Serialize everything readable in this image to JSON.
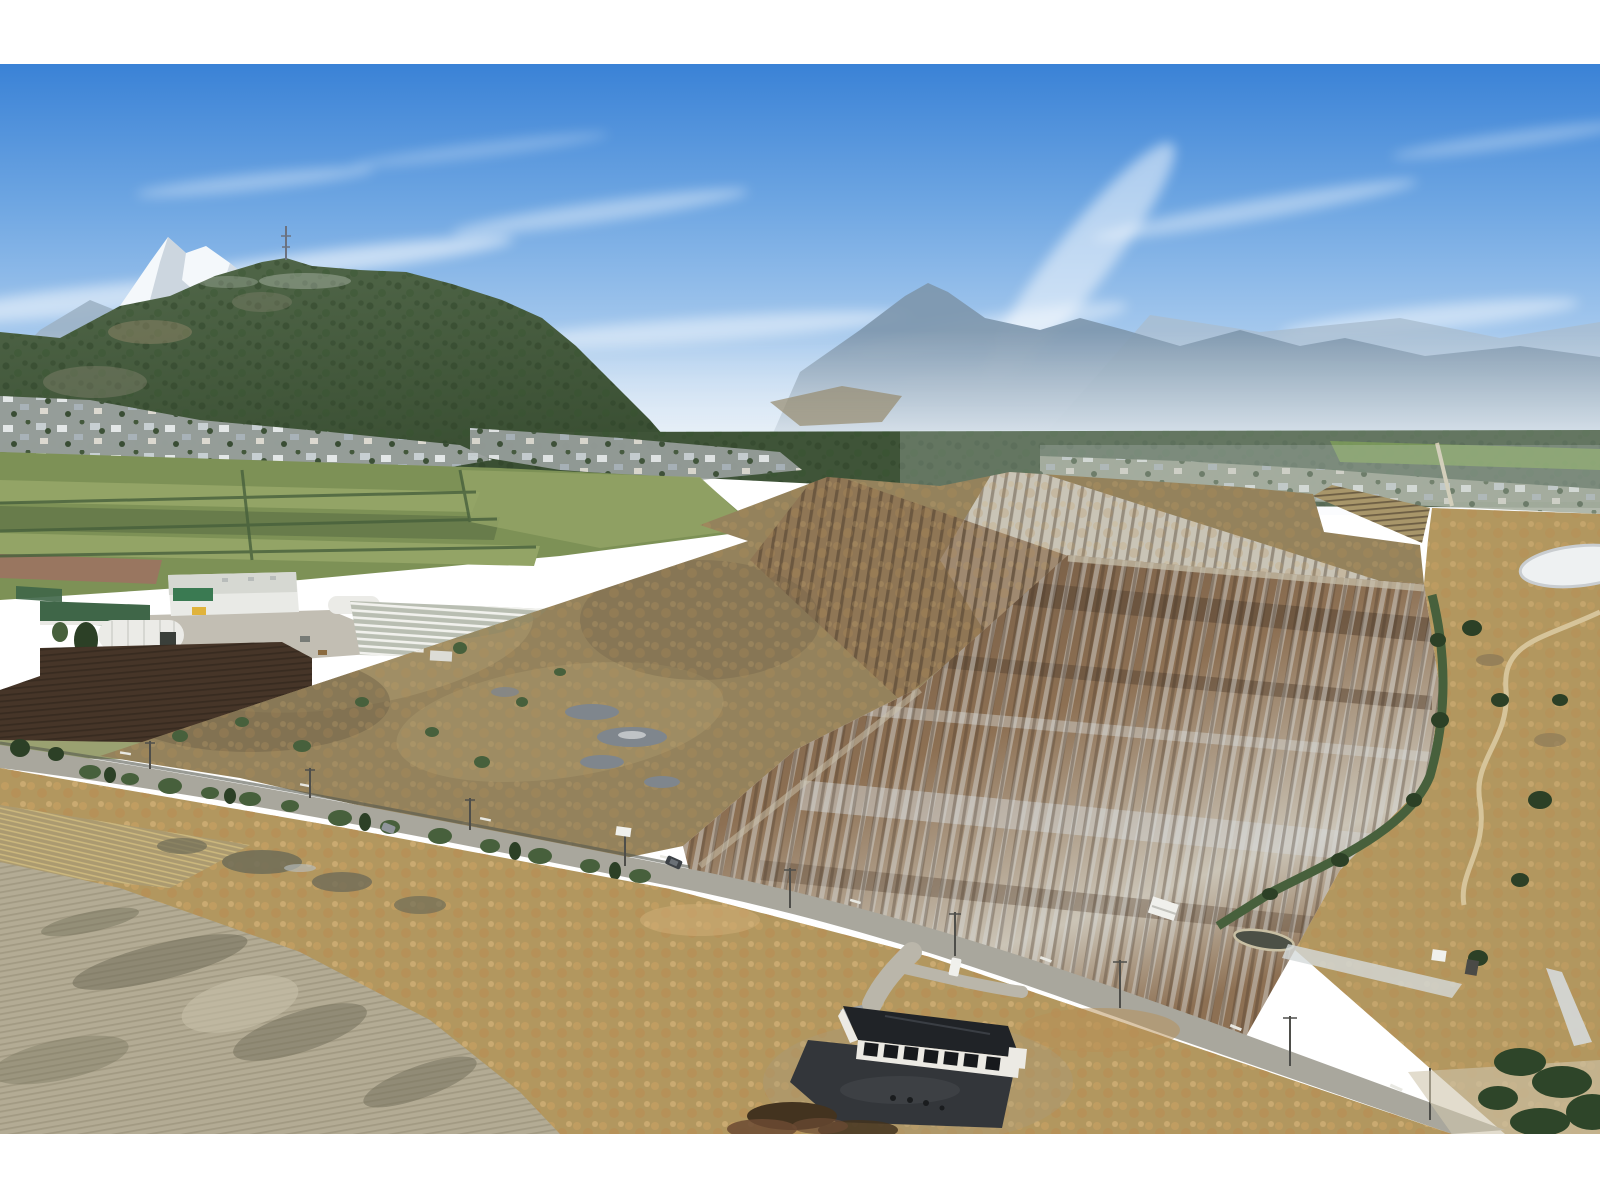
{
  "image": {
    "type": "aerial-photograph",
    "alt": "Aerial drone photo of rural farmland with a large irregular property parcel outlined in bright yellow, surrounded by farm fields, a farm building complex, flooded furrowed fields, a country road, a modern black-roofed farm building in the foreground, a forested hill, a residential neighbourhood and snow-capped mountains under a blue sky with wispy clouds"
  },
  "boundary": {
    "color": "#ffe409",
    "stroke_width_px": 15,
    "points": "100,756 748,541 700,525 827,477 940,486 1010,472 1240,487 1313,494 1324,532 1420,545 1424,584 1317,577 1183,567 1068,555 920,687 795,750 683,846 625,858 540,848 400,815 240,778"
  },
  "palette": {
    "margin": "#ffffff",
    "sky_top": "#3a82d6",
    "sky_mid": "#6ea6e2",
    "sky_soft": "#a9cbee",
    "sky_horizon": "#e2ecf7",
    "cloud": "#ffffff",
    "mtn_far": "#a9bdcf",
    "mtn_near": "#7d96ac",
    "mtn_left": "#9db2c5",
    "snow": "#f4f8fb",
    "snow_shade": "#c2cdd8",
    "haze": "#eaf1f7",
    "hill_top": "#52684a",
    "hill_dark": "#3a4f33",
    "conifer": "#2c4026",
    "valley_forest": "#3f5438",
    "clearcut": "#968a6d",
    "homes_base": "#9aa19e",
    "homes_right": "#9aa38f",
    "green_strip": "#7fa05a",
    "field_green": "#7d9156",
    "field_green_light": "#93a466",
    "field_green_dark": "#687c4b",
    "field_red": "#997660",
    "hedge": "#47603c",
    "warehouse": "#e9eae6",
    "roof_green": "#3f6648",
    "accent_green": "#3a7a52",
    "accent_yellow": "#e0b33c",
    "quonset": "#ebebe7",
    "yard": "#b7b3a6",
    "greenhouse_base": "#b9beb2",
    "row_white": "#f4f4f0",
    "plow_dark": "#463528",
    "plow_line": "#32271d",
    "verge": "#9aa171",
    "parcel_base": "#94825c",
    "parcel_light": "#a8966a",
    "parcel_dark": "#6f6247",
    "parcel_grey": "#8c8868",
    "puddle": "#7f868d",
    "flood_dark": "#6e5640",
    "flood_mid": "#8d7053",
    "flood_silver": "#cbc4b6",
    "silver": "#d6d8d6",
    "furrow_dark": "#4a3a2b",
    "upper_parcel": "#c9c4b6",
    "marsh": "#b2975f",
    "clump_a": "#c59f62",
    "clump_b": "#b78f55",
    "clump_c": "#d2b077",
    "pond_ice": "#eef1f2",
    "water_dark": "#4c5046",
    "path_tan": "#d6c49a",
    "road": "#a9a79d",
    "road_dash": "#e8e8e2",
    "gravel": "#bab6aa",
    "pad": "#33363a",
    "roof_black": "#202327",
    "wall_white": "#eceae4",
    "panel_dark": "#17191c",
    "silt": "#b3ab94",
    "silt_line": "#978f76",
    "silt_dark": "#6f6c57",
    "stubble": "#ab9a70",
    "stubble_line": "#d9c482",
    "bramble": "#43331f",
    "bramble_red": "#6b4a33",
    "pole": "#4e4e4a",
    "car_dark": "#3c4146",
    "car_grey": "#8f959a",
    "van_white": "#f0f0ec",
    "shed_dark": "#4a4a46",
    "ditch_silver": "#d5d9da",
    "tower": "#6b7280"
  }
}
